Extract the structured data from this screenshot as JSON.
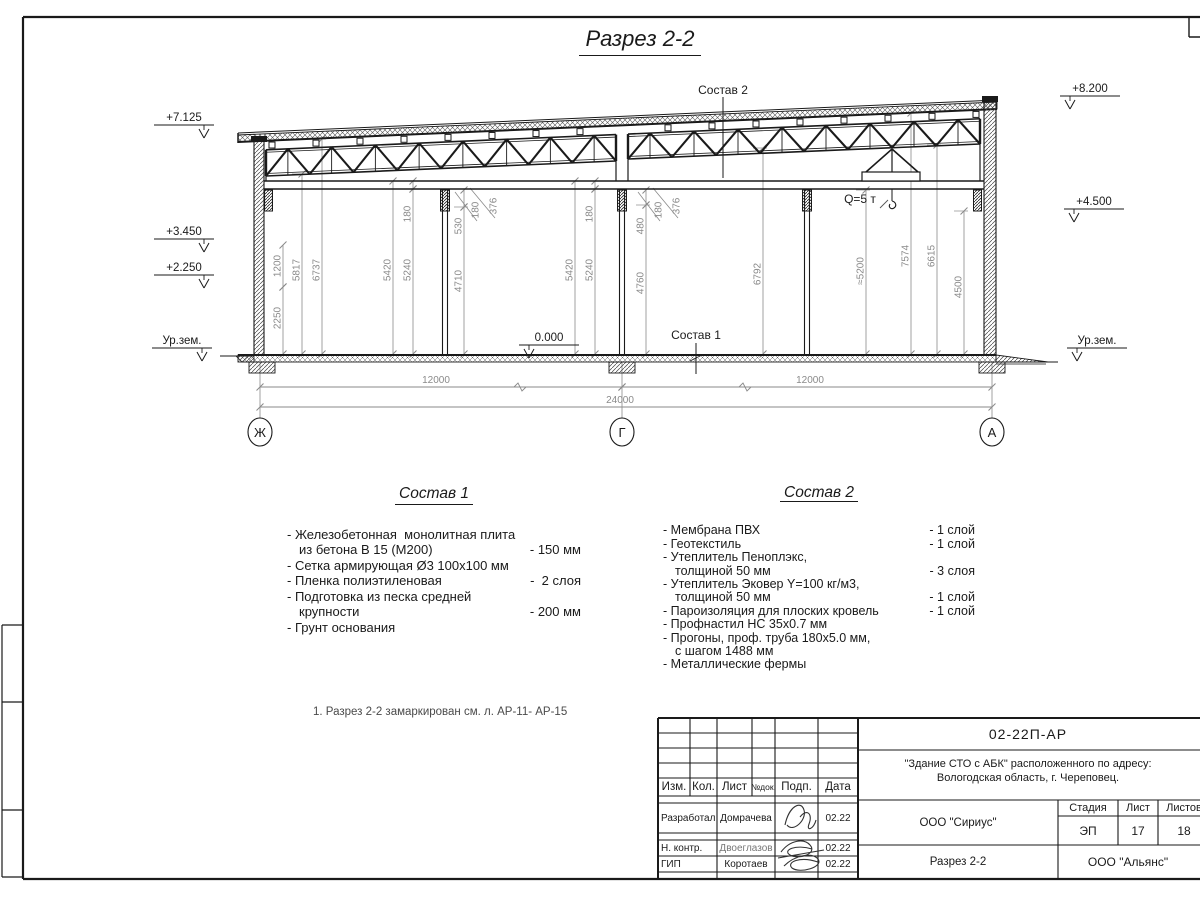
{
  "drawing_title": "Разрез 2-2",
  "section": {
    "callouts": {
      "sostav2": {
        "text": "Состав 2",
        "x": 723,
        "y": 94
      },
      "sostav1": {
        "text": "Состав 1",
        "x": 696,
        "y": 339
      },
      "crane": {
        "text": "Q=5 т",
        "x": 860,
        "y": 203
      }
    },
    "zero_mark": {
      "text": "0.000",
      "x": 549,
      "y": 341
    },
    "elev_left": [
      {
        "text": "+7.125",
        "x": 184,
        "y": 121
      },
      {
        "text": "+3.450",
        "x": 184,
        "y": 235
      },
      {
        "text": "+2.250",
        "x": 184,
        "y": 271
      },
      {
        "text": "Ур.зем.",
        "x": 182,
        "y": 344
      }
    ],
    "elev_right": [
      {
        "text": "+8.200",
        "x": 1090,
        "y": 92
      },
      {
        "text": "+4.500",
        "x": 1094,
        "y": 205
      },
      {
        "text": "Ур.зем.",
        "x": 1097,
        "y": 344
      }
    ],
    "vdims": [
      {
        "t": "1200",
        "x": 283,
        "y": 266,
        "y1": 245,
        "y2": 287
      },
      {
        "t": "2250",
        "x": 283,
        "y": 318,
        "y1": 287,
        "y2": 354
      },
      {
        "t": "5817",
        "x": 302,
        "y": 270,
        "y1": 174,
        "y2": 354
      },
      {
        "t": "6737",
        "x": 322,
        "y": 270,
        "y1": 139,
        "y2": 354
      },
      {
        "t": "5420",
        "x": 393,
        "y": 270,
        "y1": 181,
        "y2": 354
      },
      {
        "t": "180",
        "x": 413,
        "y": 214,
        "y1": 181,
        "y2": 189
      },
      {
        "t": "5240",
        "x": 413,
        "y": 270,
        "y1": 189,
        "y2": 354
      },
      {
        "t": "530",
        "x": 464,
        "y": 226,
        "y1": 190,
        "y2": 207
      },
      {
        "t": "4710",
        "x": 464,
        "y": 281,
        "y1": 207,
        "y2": 354
      },
      {
        "t": "180",
        "x": 481,
        "y": 210
      },
      {
        "t": "376",
        "x": 499,
        "y": 206
      },
      {
        "t": "5420",
        "x": 575,
        "y": 270,
        "y1": 181,
        "y2": 354
      },
      {
        "t": "180",
        "x": 595,
        "y": 214,
        "y1": 181,
        "y2": 189
      },
      {
        "t": "5240",
        "x": 595,
        "y": 270,
        "y1": 189,
        "y2": 354
      },
      {
        "t": "480",
        "x": 646,
        "y": 226,
        "y1": 190,
        "y2": 205
      },
      {
        "t": "4760",
        "x": 646,
        "y": 283,
        "y1": 205,
        "y2": 354
      },
      {
        "t": "180",
        "x": 664,
        "y": 210
      },
      {
        "t": "376",
        "x": 682,
        "y": 206
      },
      {
        "t": "6792",
        "x": 763,
        "y": 274,
        "y1": 148,
        "y2": 354
      },
      {
        "t": "≈5200",
        "x": 866,
        "y": 271,
        "y1": 190,
        "y2": 354
      },
      {
        "t": "7574",
        "x": 911,
        "y": 256,
        "y1": 113,
        "y2": 354
      },
      {
        "t": "6615",
        "x": 937,
        "y": 256,
        "y1": 145,
        "y2": 354
      },
      {
        "t": "4500",
        "x": 964,
        "y": 287,
        "y1": 211,
        "y2": 354
      }
    ],
    "leaders": [
      [
        455,
        192,
        477,
        221
      ],
      [
        470,
        188,
        495,
        218
      ],
      [
        638,
        192,
        660,
        221
      ],
      [
        653,
        188,
        678,
        218
      ]
    ],
    "hdims": [
      {
        "text": "12000",
        "x1": 260,
        "x2": 622,
        "y": 387,
        "tx": 436
      },
      {
        "text": "12000",
        "x1": 622,
        "x2": 992,
        "y": 387,
        "tx": 810
      },
      {
        "text": "24000",
        "x1": 260,
        "x2": 992,
        "y": 407,
        "tx": 620
      }
    ],
    "axes": [
      {
        "label": "Ж",
        "x": 260
      },
      {
        "label": "Г",
        "x": 622
      },
      {
        "label": "А",
        "x": 992
      }
    ]
  },
  "sostav1": {
    "title": "Состав 1",
    "items": [
      {
        "lines": [
          "- Железобетонная  монолитная плита",
          "из бетона В 15 (М200)"
        ],
        "value": "- 150 мм",
        "value_line": 1
      },
      {
        "lines": [
          "- Сетка армирующая Ø3 100х100 мм"
        ],
        "value": "",
        "value_line": 0
      },
      {
        "lines": [
          "- Пленка полиэтиленовая"
        ],
        "value": "-  2 слоя",
        "value_line": 0
      },
      {
        "lines": [
          "- Подготовка из песка средней",
          "крупности"
        ],
        "value": "- 200 мм",
        "value_line": 1
      },
      {
        "lines": [
          "- Грунт основания"
        ],
        "value": "",
        "value_line": 0
      }
    ]
  },
  "sostav2": {
    "title": "Состав 2",
    "items": [
      {
        "lines": [
          "- Мембрана ПВХ"
        ],
        "value": "- 1 слой",
        "value_line": 0
      },
      {
        "lines": [
          "- Геотекстиль"
        ],
        "value": "- 1 слой",
        "value_line": 0
      },
      {
        "lines": [
          "- Утеплитель Пеноплэкс,",
          "толщиной 50 мм"
        ],
        "value": "- 3 слоя",
        "value_line": 1
      },
      {
        "lines": [
          "- Утеплитель Эковер Y=100 кг/м3,",
          "толщиной 50 мм"
        ],
        "value": "- 1 слой",
        "value_line": 1
      },
      {
        "lines": [
          "- Пароизоляция для плоских кровель"
        ],
        "value": "- 1 слой",
        "value_line": 0
      },
      {
        "lines": [
          "- Профнастил НС 35х0.7 мм"
        ],
        "value": "",
        "value_line": 0
      },
      {
        "lines": [
          "- Прогоны, проф. труба 180х5.0 мм,",
          "с шагом 1488 мм"
        ],
        "value": "",
        "value_line": 0
      },
      {
        "lines": [
          "- Металлические фермы"
        ],
        "value": "",
        "value_line": 0
      }
    ]
  },
  "note": "1. Разрез 2-2 замаркирован см. л. АР-11- АР-15",
  "titleblock": {
    "doc_code": "02-22П-АР",
    "object_line1": "\"Здание СТО с АБК\" расположенного по адресу:",
    "object_line2": "Вологодская область, г. Череповец.",
    "org1": "ООО \"Сириус\"",
    "sheet_title": "Разрез 2-2",
    "org2": "ООО \"Альянс\"",
    "cols": [
      "Изм.",
      "Кол.",
      "Лист",
      "№док.",
      "Подп.",
      "Дата"
    ],
    "rows": [
      {
        "role": "Разработал",
        "name": "Домрачева",
        "date": "02.22"
      },
      {
        "role": "Н. контр.",
        "name": "Двоеглазов",
        "date": "02.22"
      },
      {
        "role": "ГИП",
        "name": "Коротаев",
        "date": "02.22"
      }
    ],
    "stage_label": "Стадия",
    "sheet_label": "Лист",
    "sheets_label": "Листов",
    "stage": "ЭП",
    "sheet_num": "17",
    "sheets_total": "18"
  }
}
